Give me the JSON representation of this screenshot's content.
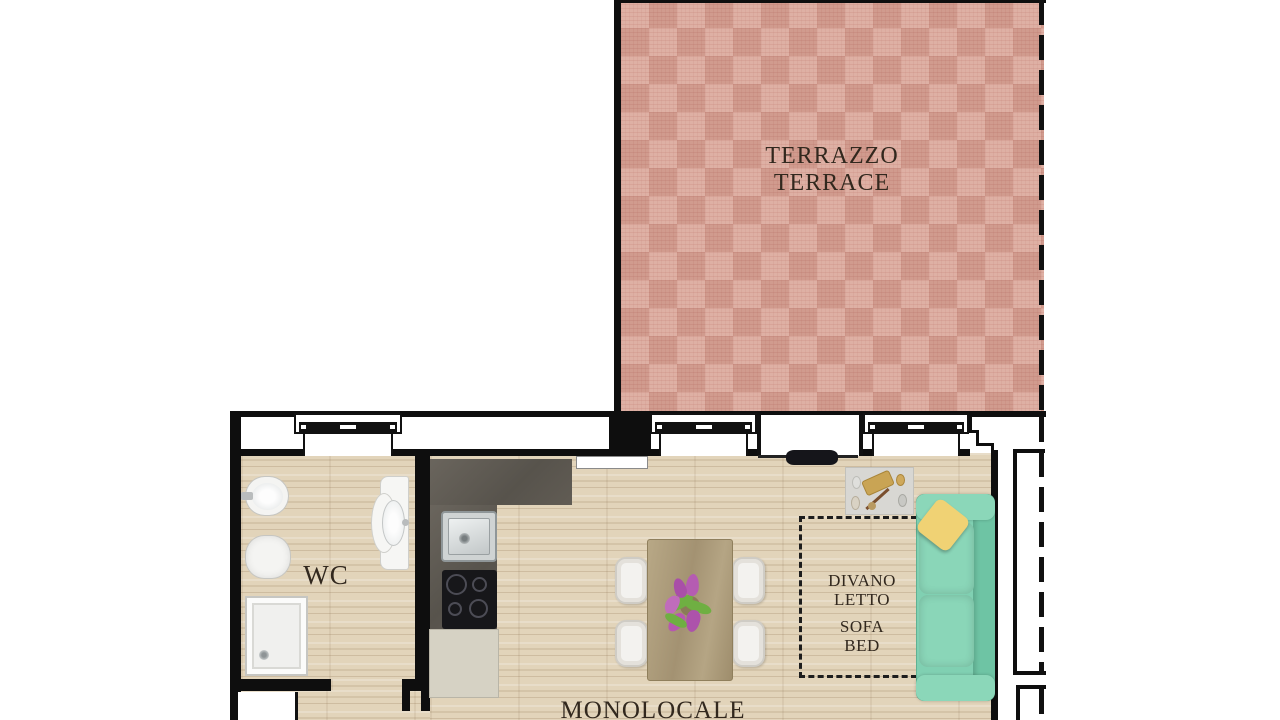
{
  "labels": {
    "terrace_line1": "TERRAZZO",
    "terrace_line2": "TERRACE",
    "wc": "WC",
    "divano_line1": "DIVANO",
    "divano_line2": "LETTO",
    "divano_line3": "SOFA",
    "divano_line4": "BED",
    "studio": "MONOLOCALE"
  },
  "colors": {
    "terrace_tile": "#dba89b",
    "wood_floor": "#e2d4ba",
    "wall": "#0e0e0e",
    "kitchen_counter": "#5f5a53",
    "kitchen_cabinet": "#d6d2c4",
    "dining_table": "#b2a282",
    "chair": "#f3f2ef",
    "sofa": "#80d0b2",
    "pillow": "#f0d274",
    "label_text": "#32281e"
  },
  "objects": [
    "terrace",
    "wc-room",
    "studio-room",
    "sofa-bed",
    "yellow-pillow",
    "doormat-with-accessories",
    "dining-table",
    "dining-chairs",
    "flower-centerpiece",
    "kitchen-counter",
    "kitchen-sink",
    "cooktop",
    "kitchen-cabinet",
    "bidet",
    "toilet",
    "vanity-sink",
    "shower-tray",
    "windows",
    "terrace-door-opening",
    "wall-mounted-tv",
    "shaft"
  ]
}
